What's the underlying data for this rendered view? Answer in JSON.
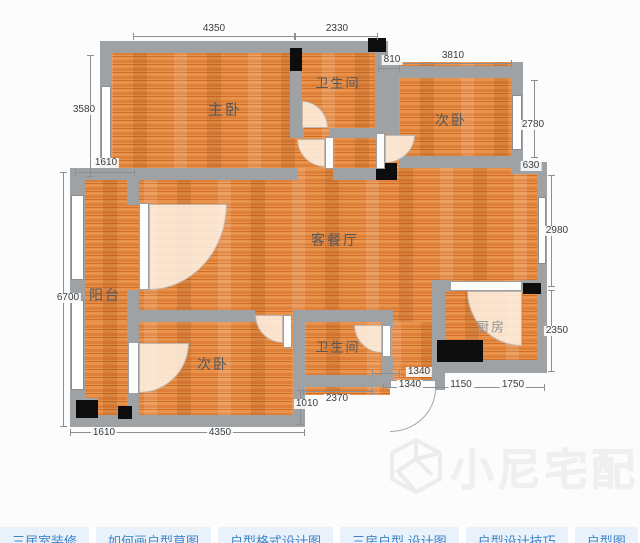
{
  "rooms": [
    {
      "id": "master-bedroom",
      "label": "主卧"
    },
    {
      "id": "bathroom-top",
      "label": "卫生间"
    },
    {
      "id": "bedroom-top-right",
      "label": "次卧"
    },
    {
      "id": "living-dining",
      "label": "客餐厅"
    },
    {
      "id": "balcony",
      "label": "阳台"
    },
    {
      "id": "bedroom-bottom",
      "label": "次卧"
    },
    {
      "id": "bathroom-bottom",
      "label": "卫生间"
    },
    {
      "id": "kitchen",
      "label": "厨房"
    }
  ],
  "dims": [
    {
      "id": "top-master-width",
      "label": "4350"
    },
    {
      "id": "top-bath-width",
      "label": "2330"
    },
    {
      "id": "shaft-width",
      "label": "810"
    },
    {
      "id": "bedroom2-width",
      "label": "3810"
    },
    {
      "id": "master-height",
      "label": "3580"
    },
    {
      "id": "bedroom2-height",
      "label": "2780"
    },
    {
      "id": "step-height",
      "label": "630"
    },
    {
      "id": "balcony-width-top",
      "label": "1610"
    },
    {
      "id": "living-height",
      "label": "2980"
    },
    {
      "id": "balcony-height",
      "label": "6700"
    },
    {
      "id": "kitchen-height",
      "label": "2350"
    },
    {
      "id": "balcony-width-bottom",
      "label": "1610"
    },
    {
      "id": "bedroom3-width",
      "label": "4350"
    },
    {
      "id": "entry-step",
      "label": "1010"
    },
    {
      "id": "bath2-width",
      "label": "2370"
    },
    {
      "id": "entry-width-a",
      "label": "1340"
    },
    {
      "id": "entry-width-b",
      "label": "1340"
    },
    {
      "id": "kitchen-door-width",
      "label": "1150"
    },
    {
      "id": "kitchen-width",
      "label": "1750"
    }
  ],
  "watermark": {
    "text": "小尼宅配"
  },
  "footer": {
    "tags": [
      "三居室装修",
      "如何画户型草图",
      "户型格式设计图",
      "三房户型 设计图",
      "户型设计技巧",
      "户型图"
    ]
  },
  "colors": {
    "floor": "#e8924c",
    "wall": "#9fa2a5",
    "marker": "#0d0d0d",
    "dim_text": "#393d40",
    "label_text": "#54585b",
    "tag_text": "#3f84c9",
    "watermark": "#efefef"
  }
}
